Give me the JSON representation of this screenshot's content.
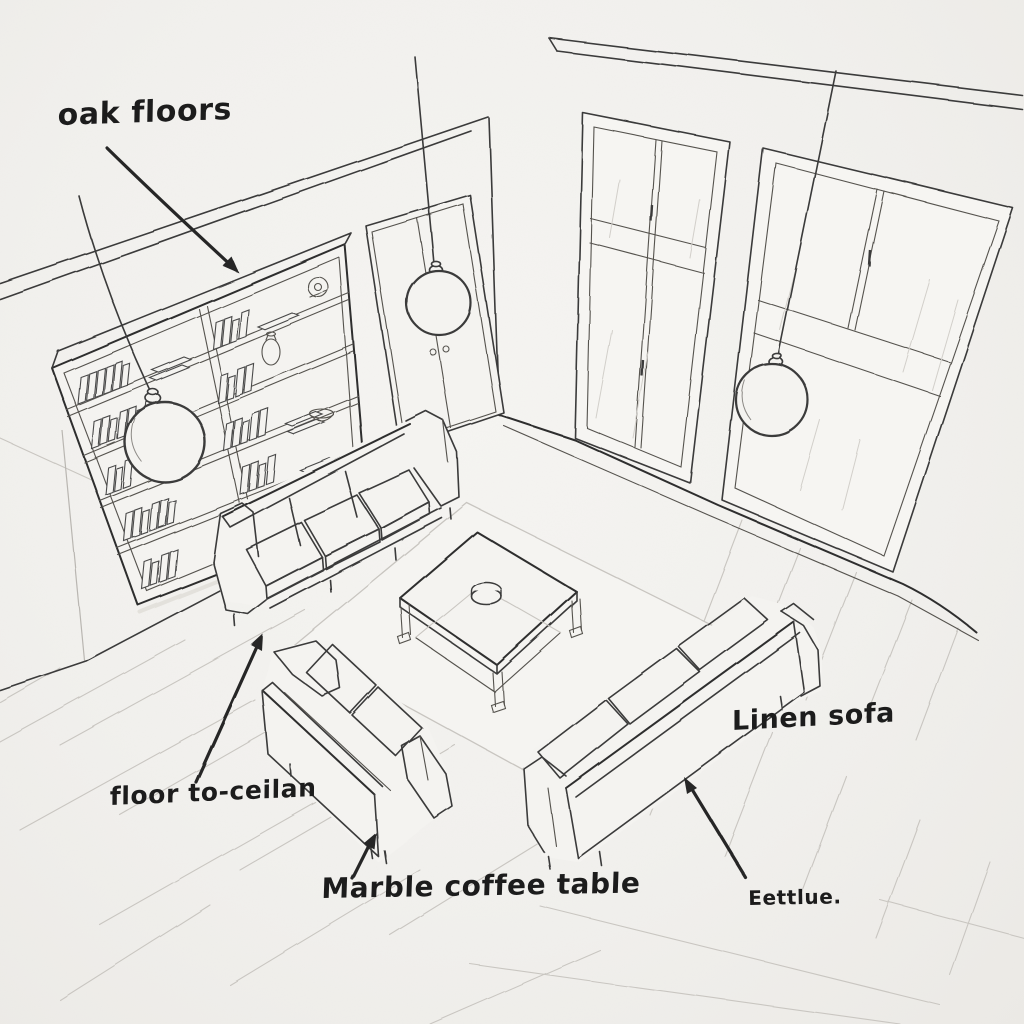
{
  "scene": {
    "title": "Living room concept sketch",
    "medium": "hand-drawn ink and pencil interior sketch on paper",
    "view": "elevated three-quarter view of a living room corner"
  },
  "palette": {
    "paper": "#f3f2ef",
    "ink": "#3a3a3a",
    "ink_dark": "#262626",
    "pencil_light": "#c9c6c1"
  },
  "annotations": [
    {
      "id": "oak-floors",
      "text": "oak floors",
      "arrow_points_to": "top edge of the bookshelf / oak plank floor area"
    },
    {
      "id": "floor-to-ceiling",
      "text": "floor to-ceilan",
      "arrow_points_to": "front leg of the sofa by the bookshelf"
    },
    {
      "id": "marble-coffee-table",
      "text": "Marble coffee table",
      "arrow_points_to": "leg of the small loveseat beside the coffee table"
    },
    {
      "id": "linen-sofa",
      "text": "Linen sofa",
      "arrow_points_to": "backrest of the long sofa on the right"
    },
    {
      "id": "bottom-right-note",
      "text": "Eettlue.",
      "arrow_points_to": ""
    }
  ],
  "objects": {
    "bookshelf": "wall bookcase, two columns, five shelves, filled with books, clock, vase and bowl",
    "door": "double interior door with two knobs",
    "windows": "two floor-to-ceiling window bays with mullions",
    "pendants": "three globe pendant lights on long cords",
    "sofa_left": "three-seat sofa facing the coffee table",
    "loveseat": "two-seat loveseat seen from behind",
    "sofa_right": "three-seat linen sofa seen from behind",
    "coffee_table": "square coffee table with lower shelf and a small bowl on top",
    "rug": "square area rug",
    "floor": "oak plank floor"
  }
}
